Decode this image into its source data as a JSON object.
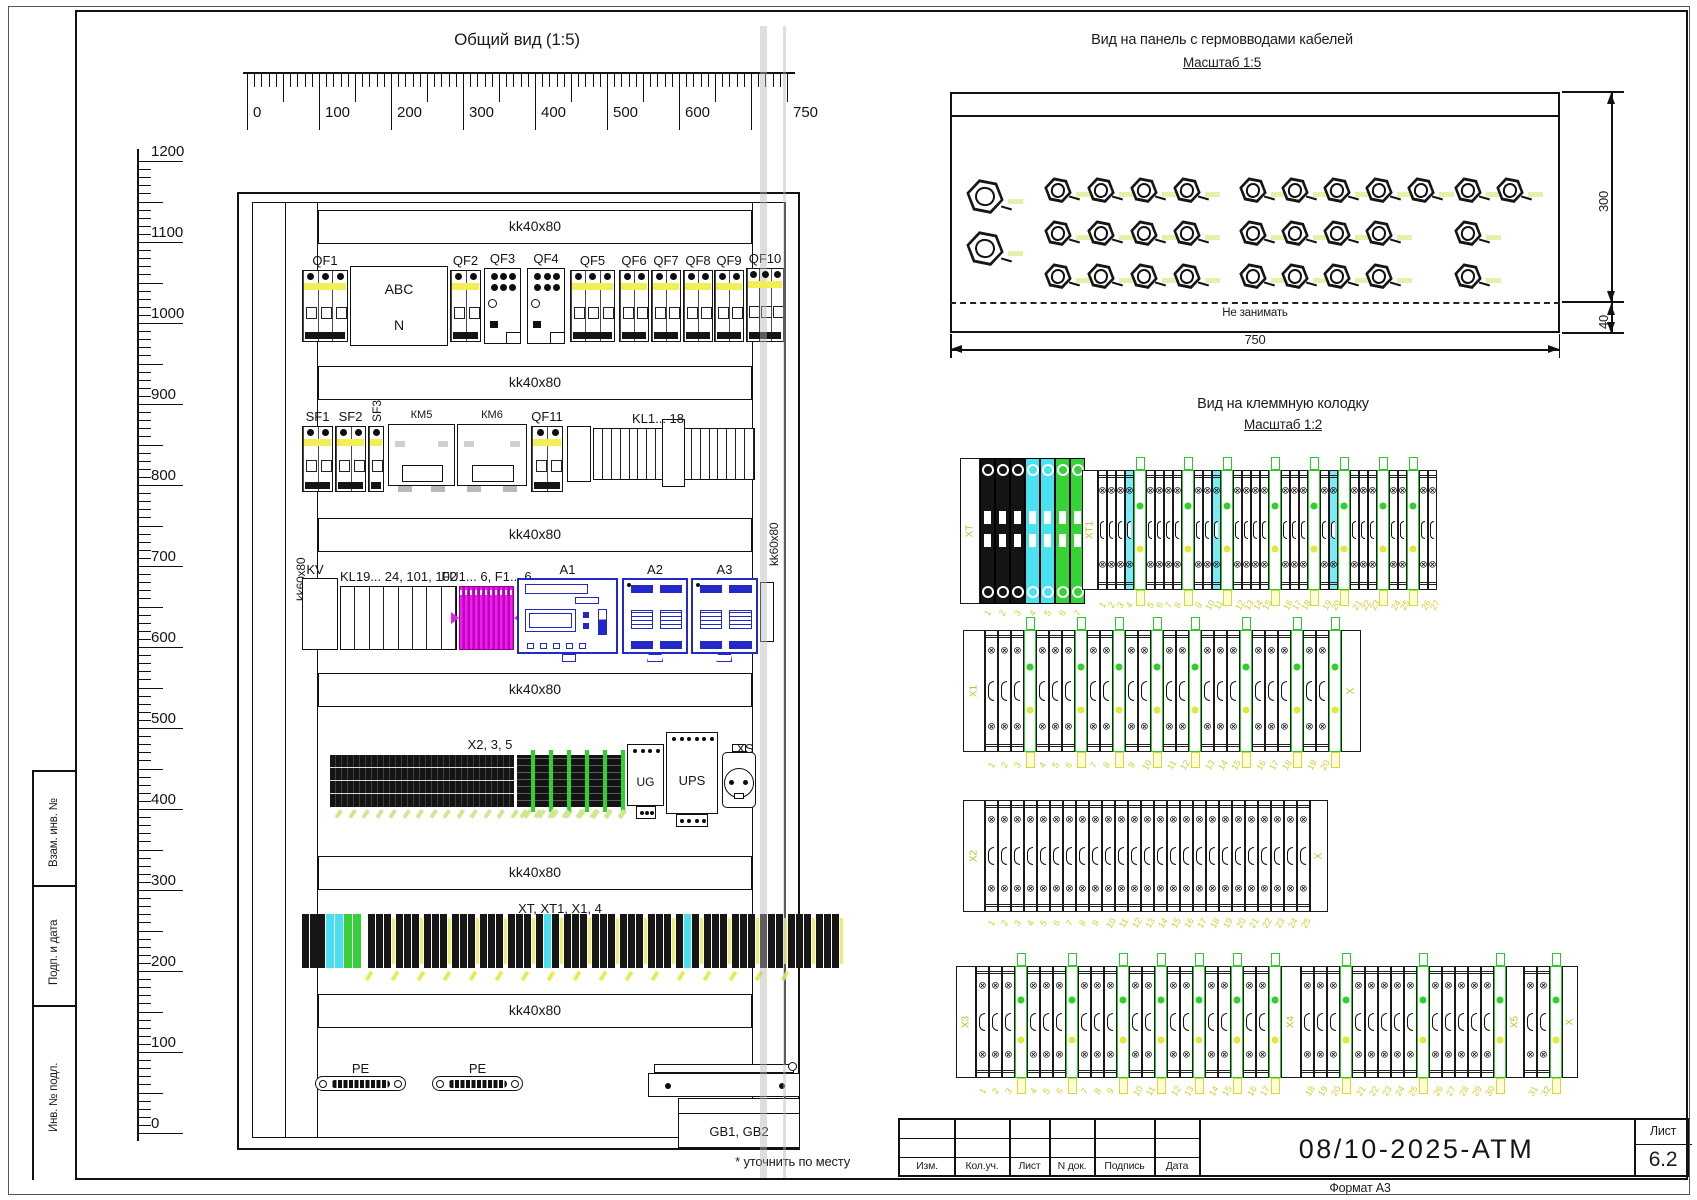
{
  "sidebar": {
    "labels": [
      "Взам. инв. №",
      "Подп. и дата",
      "Инв. № подл."
    ]
  },
  "general_view": {
    "title": "Общий вид (1:5)",
    "footnote": "* уточнить по месту",
    "rail_h_label": "kk40x80",
    "rail_v_label": "kk60x80",
    "h_ruler_labels": [
      [
        0,
        "0"
      ],
      [
        100,
        "100"
      ],
      [
        200,
        "200"
      ],
      [
        300,
        "300"
      ],
      [
        400,
        "400"
      ],
      [
        500,
        "500"
      ],
      [
        600,
        "600"
      ],
      [
        750,
        "750"
      ]
    ],
    "v_ruler_labels": [
      [
        1200,
        "1200"
      ],
      [
        1100,
        "1100"
      ],
      [
        1000,
        "1000"
      ],
      [
        900,
        "900"
      ],
      [
        800,
        "800"
      ],
      [
        700,
        "700"
      ],
      [
        600,
        "600"
      ],
      [
        500,
        "500"
      ],
      [
        400,
        "400"
      ],
      [
        300,
        "300"
      ],
      [
        200,
        "200"
      ],
      [
        100,
        "100"
      ],
      [
        0,
        "0"
      ]
    ]
  },
  "gland_view": {
    "title": "Вид на панель с гермовводами кабелей",
    "scale": "Масштаб 1:5",
    "keepout": "Не занимать",
    "dim_width": "750",
    "dim_height": "300",
    "dim_bottom": "40"
  },
  "terminal_view": {
    "title": "Вид на клеммную колодку",
    "scale": "Масштаб 1:2"
  },
  "title_block": {
    "doc_number": "08/10-2025-АТМ",
    "sheet_label": "Лист",
    "sheet_number": "6.2",
    "format": "Формат А3",
    "columns": [
      "Изм.",
      "Кол.уч.",
      "Лист",
      "N док.",
      "Подпись",
      "Дата"
    ]
  },
  "layout": {
    "frame": {
      "outer": [
        8,
        6,
        1682,
        1189
      ],
      "main": [
        75,
        10,
        1613,
        1170
      ],
      "sidebar_x": 32,
      "sidebar_ys": [
        770,
        885,
        1005
      ],
      "sidebar_label_tops": [
        867,
        985,
        1132
      ]
    },
    "h_ruler": {
      "x0": 247,
      "y": 72,
      "px": 0.72,
      "max": 750
    },
    "v_ruler": {
      "x": 137,
      "y0": 1133,
      "px": 0.81,
      "max": 1200
    },
    "cabinet": {
      "outer": [
        237,
        192,
        563,
        958
      ],
      "inner": [
        252,
        202,
        534,
        936
      ],
      "left_rail": [
        285,
        202,
        33,
        936
      ],
      "right_rail": [
        752,
        202,
        33,
        936
      ],
      "bands_x": 318,
      "bands_w": 434,
      "bands_h": 34,
      "bands_y": [
        210,
        366,
        518,
        673,
        856,
        994
      ],
      "v_label_left": [
        296,
        601
      ],
      "v_label_right": [
        769,
        566
      ]
    },
    "gray_lines": [
      [
        760,
        26,
        7,
        1152
      ],
      [
        783,
        26,
        3,
        1152
      ]
    ],
    "devices": [
      {
        "t": "brk",
        "label": "QF1",
        "x": 302,
        "y": 270,
        "w": 46,
        "h": 72,
        "p": 3
      },
      {
        "t": "abox",
        "l1": "ABC",
        "l2": "N",
        "x": 350,
        "y": 266,
        "w": 98,
        "h": 80
      },
      {
        "t": "brk",
        "label": "QF2",
        "x": 450,
        "y": 270,
        "w": 31,
        "h": 72,
        "p": 2
      },
      {
        "t": "cont",
        "label": "QF3",
        "x": 484,
        "y": 268,
        "w": 37,
        "h": 76
      },
      {
        "t": "cont",
        "label": "QF4",
        "x": 527,
        "y": 268,
        "w": 38,
        "h": 76
      },
      {
        "t": "brk",
        "label": "QF5",
        "x": 570,
        "y": 270,
        "w": 45,
        "h": 72,
        "p": 3
      },
      {
        "t": "brk",
        "label": "QF6",
        "x": 619,
        "y": 270,
        "w": 30,
        "h": 72,
        "p": 2
      },
      {
        "t": "brk",
        "label": "QF7",
        "x": 651,
        "y": 270,
        "w": 30,
        "h": 72,
        "p": 2
      },
      {
        "t": "brk",
        "label": "QF8",
        "x": 683,
        "y": 270,
        "w": 30,
        "h": 72,
        "p": 2
      },
      {
        "t": "brk",
        "label": "QF9",
        "x": 714,
        "y": 270,
        "w": 30,
        "h": 72,
        "p": 2
      },
      {
        "t": "brk",
        "label": "QF10",
        "x": 746,
        "y": 268,
        "w": 38,
        "h": 74,
        "p": 3
      },
      {
        "t": "brk",
        "label": "SF1",
        "x": 302,
        "y": 426,
        "w": 31,
        "h": 66,
        "p": 2
      },
      {
        "t": "brk",
        "label": "SF2",
        "x": 335,
        "y": 426,
        "w": 31,
        "h": 66,
        "p": 2
      },
      {
        "t": "brk",
        "label": "SF3",
        "x": 368,
        "y": 426,
        "w": 16,
        "h": 66,
        "p": 1,
        "vl": true
      },
      {
        "t": "km",
        "label": "КМ5",
        "x": 388,
        "y": 424,
        "w": 67,
        "h": 62
      },
      {
        "t": "km",
        "label": "КМ6",
        "x": 457,
        "y": 424,
        "w": 70,
        "h": 62
      },
      {
        "t": "brk",
        "label": "QF11",
        "x": 531,
        "y": 426,
        "w": 32,
        "h": 66,
        "p": 2
      },
      {
        "t": "blank",
        "x": 567,
        "y": 426,
        "w": 24,
        "h": 56
      },
      {
        "t": "comb",
        "label": "KL1... 18",
        "x": 593,
        "y": 428,
        "w": 162,
        "h": 52,
        "cells": 18,
        "big": 8,
        "lx": 658
      },
      {
        "t": "box",
        "label": "KV",
        "x": 302,
        "y": 578,
        "w": 36,
        "h": 72,
        "lx": 315
      },
      {
        "t": "comb",
        "label": "KL19... 24, 101, 102",
        "x": 340,
        "y": 586,
        "w": 117,
        "h": 64,
        "cells": 8
      },
      {
        "t": "fu",
        "label": "FU1... 6, F1... 6",
        "x": 459,
        "y": 586,
        "w": 55,
        "h": 64
      },
      {
        "t": "plc",
        "label": "A1",
        "x": 517,
        "y": 578,
        "w": 101,
        "h": 76
      },
      {
        "t": "mod",
        "label": "A2",
        "x": 622,
        "y": 578,
        "w": 66,
        "h": 76
      },
      {
        "t": "mod",
        "label": "A3",
        "x": 691,
        "y": 578,
        "w": 67,
        "h": 76
      },
      {
        "t": "blank",
        "x": 760,
        "y": 582,
        "w": 14,
        "h": 60
      },
      {
        "t": "xstrip1",
        "label": "X2, 3, 5",
        "x": 330,
        "y": 755,
        "w": 184,
        "h": 52,
        "lx": 490
      },
      {
        "t": "xstrip2",
        "x": 517,
        "y": 755,
        "w": 108,
        "h": 52
      },
      {
        "t": "ug",
        "label": "UG",
        "x": 627,
        "y": 744,
        "w": 37,
        "h": 62
      },
      {
        "t": "ups",
        "label": "UPS",
        "x": 666,
        "y": 732,
        "w": 52,
        "h": 82
      },
      {
        "t": "xs",
        "label": "XS",
        "x": 722,
        "y": 752,
        "w": 34,
        "h": 56
      },
      {
        "t": "xtstrip",
        "label": "XT, XT1, X1, 4",
        "x": 302,
        "y": 914,
        "w": 484,
        "h": 54,
        "lx": 560
      },
      {
        "t": "pe",
        "label": "PE",
        "x": 315,
        "y": 1076,
        "w": 91,
        "h": 15
      },
      {
        "t": "pe",
        "label": "PE",
        "x": 432,
        "y": 1076,
        "w": 91,
        "h": 15
      },
      {
        "t": "bracket",
        "x": 648,
        "y": 1064,
        "w": 152,
        "h": 40
      },
      {
        "t": "gb",
        "label": "GB1, GB2",
        "x": 678,
        "y": 1098,
        "w": 122,
        "h": 50
      }
    ],
    "gland": {
      "rect": [
        950,
        92,
        610,
        241
      ],
      "topline": 115,
      "dash_y": 302,
      "dim_y": 349,
      "dim_x": 1611,
      "big": [
        [
          985,
          197
        ],
        [
          985,
          249
        ]
      ],
      "small": [
        [
          1058,
          190
        ],
        [
          1101,
          190
        ],
        [
          1144,
          190
        ],
        [
          1187,
          190
        ],
        [
          1058,
          233
        ],
        [
          1101,
          233
        ],
        [
          1144,
          233
        ],
        [
          1187,
          233
        ],
        [
          1058,
          276
        ],
        [
          1101,
          276
        ],
        [
          1144,
          276
        ],
        [
          1187,
          276
        ],
        [
          1253,
          190
        ],
        [
          1295,
          190
        ],
        [
          1337,
          190
        ],
        [
          1379,
          190
        ],
        [
          1421,
          190
        ],
        [
          1468,
          190
        ],
        [
          1510,
          190
        ],
        [
          1253,
          233
        ],
        [
          1295,
          233
        ],
        [
          1337,
          233
        ],
        [
          1379,
          233
        ],
        [
          1468,
          233
        ],
        [
          1253,
          276
        ],
        [
          1295,
          276
        ],
        [
          1337,
          276
        ],
        [
          1379,
          276
        ],
        [
          1468,
          276
        ]
      ]
    },
    "strips": [
      {
        "x": 960,
        "y": 458,
        "h": 146,
        "cw": 15,
        "tagy": 608,
        "units": [
          {
            "k": "pl",
            "w": 20,
            "lab": "XT"
          },
          {
            "k": "kc",
            "n": 3
          },
          {
            "k": "yc",
            "n": 2
          },
          {
            "k": "nc",
            "n": 2
          }
        ]
      },
      {
        "x": 1082,
        "y": 470,
        "h": 120,
        "cw": 9,
        "tagy": 600,
        "units": [
          {
            "k": "pl",
            "w": 16,
            "lab": "XT1"
          },
          {
            "k": "t",
            "n": 3
          },
          {
            "k": "c",
            "n": 1
          },
          {
            "k": "g"
          },
          {
            "k": "t",
            "n": 4
          },
          {
            "k": "g"
          },
          {
            "k": "t",
            "n": 2
          },
          {
            "k": "c",
            "n": 1
          },
          {
            "k": "g"
          },
          {
            "k": "t",
            "n": 4
          },
          {
            "k": "g"
          },
          {
            "k": "t",
            "n": 3
          },
          {
            "k": "g"
          },
          {
            "k": "t",
            "n": 1
          },
          {
            "k": "c",
            "n": 1
          },
          {
            "k": "g"
          },
          {
            "k": "t",
            "n": 3
          },
          {
            "k": "g"
          },
          {
            "k": "t",
            "n": 2
          },
          {
            "k": "g"
          },
          {
            "k": "t",
            "n": 2
          }
        ]
      },
      {
        "x": 963,
        "y": 630,
        "h": 122,
        "cw": 13,
        "tagy": 760,
        "units": [
          {
            "k": "pl",
            "w": 22,
            "lab": "X1"
          },
          {
            "k": "t",
            "n": 3
          },
          {
            "k": "g"
          },
          {
            "k": "t",
            "n": 3
          },
          {
            "k": "g"
          },
          {
            "k": "t",
            "n": 2
          },
          {
            "k": "g"
          },
          {
            "k": "t",
            "n": 2
          },
          {
            "k": "g"
          },
          {
            "k": "t",
            "n": 2
          },
          {
            "k": "g"
          },
          {
            "k": "t",
            "n": 3
          },
          {
            "k": "g"
          },
          {
            "k": "t",
            "n": 3
          },
          {
            "k": "g"
          },
          {
            "k": "t",
            "n": 2
          },
          {
            "k": "g"
          },
          {
            "k": "pl",
            "w": 20,
            "lab": "X"
          }
        ]
      },
      {
        "x": 963,
        "y": 800,
        "h": 112,
        "cw": 13,
        "tagy": 918,
        "units": [
          {
            "k": "pl",
            "w": 22,
            "lab": "X2"
          },
          {
            "k": "t",
            "n": 25
          },
          {
            "k": "pl",
            "w": 18,
            "lab": "X"
          }
        ]
      },
      {
        "x": 956,
        "y": 966,
        "h": 112,
        "cw": 13,
        "tagy": 1086,
        "units": [
          {
            "k": "pl",
            "w": 20,
            "lab": "X3"
          },
          {
            "k": "t",
            "n": 3
          },
          {
            "k": "g"
          },
          {
            "k": "t",
            "n": 3
          },
          {
            "k": "g"
          },
          {
            "k": "t",
            "n": 3
          },
          {
            "k": "g"
          },
          {
            "k": "t",
            "n": 2
          },
          {
            "k": "g"
          },
          {
            "k": "t",
            "n": 2
          },
          {
            "k": "g"
          },
          {
            "k": "t",
            "n": 2
          },
          {
            "k": "g"
          },
          {
            "k": "t",
            "n": 2
          },
          {
            "k": "g"
          },
          {
            "k": "pl",
            "w": 20,
            "lab": "X4"
          },
          {
            "k": "t",
            "n": 3
          },
          {
            "k": "g"
          },
          {
            "k": "t",
            "n": 5
          },
          {
            "k": "g"
          },
          {
            "k": "t",
            "n": 5
          },
          {
            "k": "g"
          },
          {
            "k": "pl",
            "w": 18,
            "lab": "X5"
          },
          {
            "k": "t",
            "n": 2
          },
          {
            "k": "g"
          },
          {
            "k": "pl",
            "w": 16,
            "lab": "X"
          }
        ]
      }
    ]
  }
}
